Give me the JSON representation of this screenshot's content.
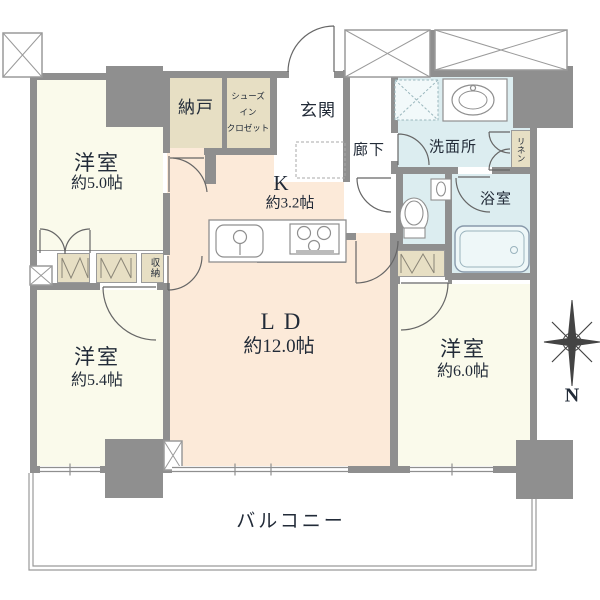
{
  "floorplan": {
    "rooms": {
      "bedroom1": {
        "name": "洋室",
        "size": "約5.0帖"
      },
      "bedroom2": {
        "name": "洋室",
        "size": "約5.4帖"
      },
      "bedroom3": {
        "name": "洋室",
        "size": "約6.0帖"
      },
      "living_dining": {
        "name": "LD",
        "size": "約12.0帖"
      },
      "kitchen": {
        "name": "K",
        "size": "約3.2帖"
      },
      "storage_room": {
        "name": "納戸"
      },
      "shoes_in_closet": {
        "line1": "シューズ",
        "line2": "イン",
        "line3": "クロゼット"
      },
      "entrance": {
        "name": "玄関"
      },
      "hallway": {
        "name": "廊下"
      },
      "washroom": {
        "name": "洗面所"
      },
      "bathroom": {
        "name": "浴室"
      },
      "linen": {
        "name": "リネン"
      },
      "closet": {
        "name": "収納"
      },
      "balcony": {
        "name": "バルコニー"
      }
    },
    "compass": {
      "north_label": "N"
    },
    "colors": {
      "wall": "#8f8f8f",
      "western_room": "#fafaeb",
      "ldk": "#fcead9",
      "service": "#e7dfc4",
      "wet_area": "#dcedf0",
      "text": "#222b38"
    }
  }
}
